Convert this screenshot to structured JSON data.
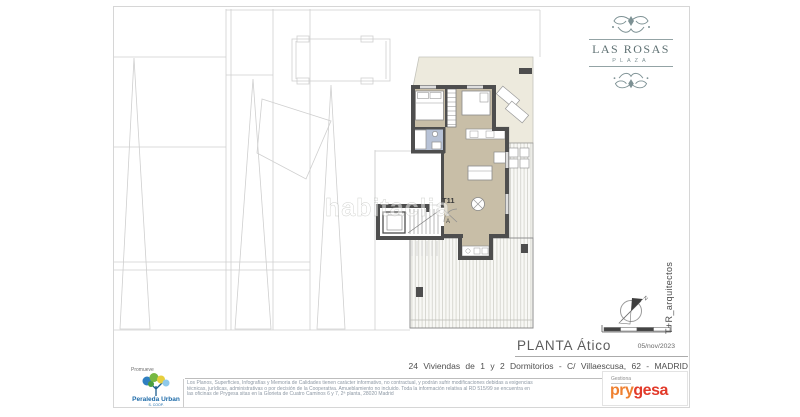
{
  "branding": {
    "project_logo": {
      "line1": "LAS ROSAS",
      "line2": "PLAZA"
    },
    "architect": "T+R_arquitectos",
    "developer": {
      "promoter_label": "Promueve",
      "name": "Peraleda Urban",
      "sub": "S. COOP."
    },
    "manager": {
      "label": "Gestiona",
      "name_left": "pry",
      "name_right": "gesa"
    }
  },
  "titleblock": {
    "plan_title": "PLANTA Ático",
    "date": "05/nov/2023",
    "project_line": "24 Viviendas de 1 y 2 Dormitorios - C/ Villaescusa, 62 - MADRID",
    "disclaimer_line1": "Los Planos, Superficies, Infografías y Memoria de Calidades tienen carácter informativo, no contractual, y podrán sufrir modificaciones debidas a exigencias",
    "disclaimer_line2": "técnicas, jurídicas, administrativas o por decisión de la Cooperativa. Amueblamiento no incluido. Toda la información relativa al RD 515/99 se encuentra en",
    "disclaimer_line3": "las oficinas de Prygesa sitas en la Glorieta de Cuatro Caminos 6 y 7, 2ª planta, 28020 Madrid"
  },
  "plan": {
    "unit_label": "T11",
    "entrance_label": "A",
    "north_label": "N",
    "watermark": "habitaclia"
  },
  "colors": {
    "wall": "#4e4e4e",
    "floor_tan": "#c8bea7",
    "bath_blue": "#b7c2d6",
    "terrace_cream": "#edeadd",
    "logo_teal": "#7d9194",
    "prygesa_orange": "#ef8030",
    "prygesa_red": "#e23a2a",
    "peraleda_blue": "#1c6aa8"
  }
}
